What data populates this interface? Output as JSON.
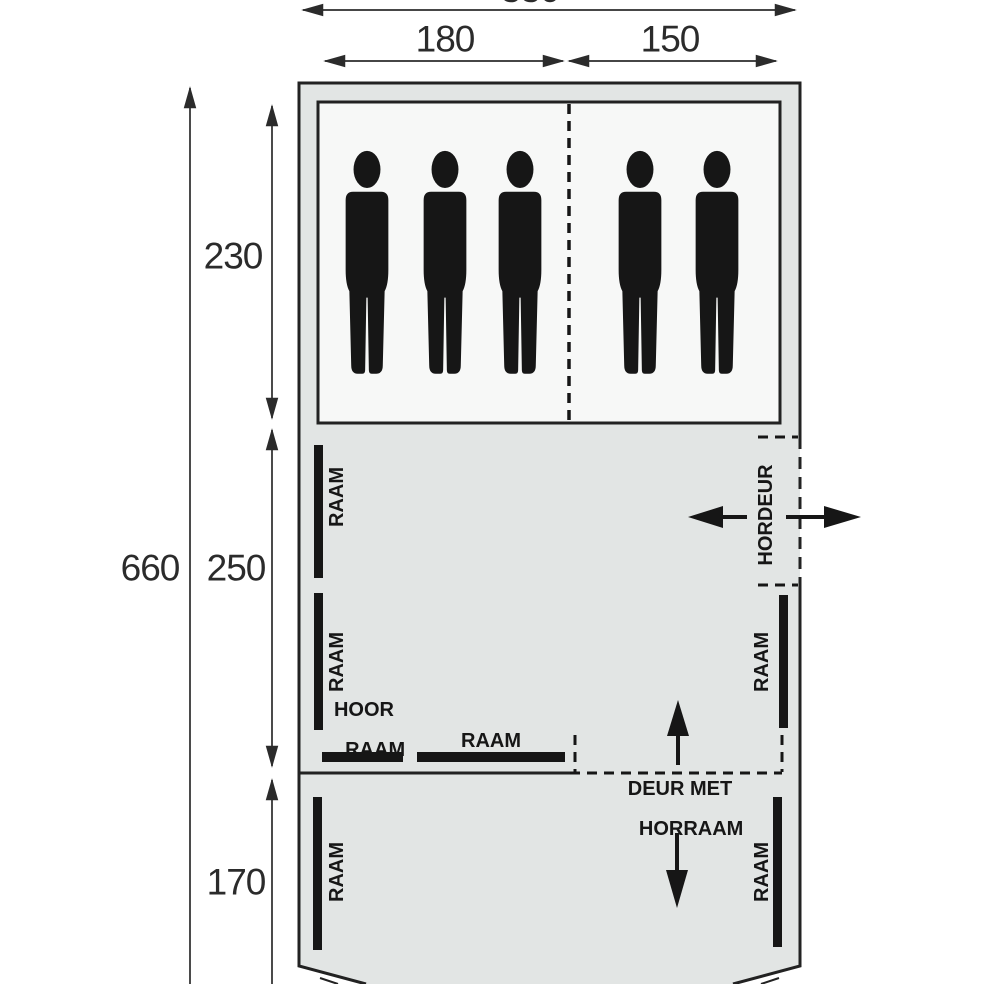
{
  "title": "tent-floorplan",
  "dimensions": {
    "width_total": "330",
    "width_left": "180",
    "width_right": "150",
    "length_total": "660",
    "length_sleeping": "230",
    "length_living": "250",
    "length_front": "170"
  },
  "labels": {
    "window": "RAAM",
    "screen_door": "HORDEUR",
    "screen_window_line1": "HOOR",
    "screen_window_line2": "RAAM",
    "door_line1": "DEUR MET",
    "door_line2": "HORRAAM"
  },
  "sleeping_area": {
    "left_section_persons": 3,
    "right_section_persons": 2
  },
  "colors": {
    "tent_fill": "#e2e5e4",
    "sleeping_fill": "#f7f8f7",
    "ink": "#161616",
    "outline": "#222222",
    "dimension": "#2b2b2b"
  }
}
